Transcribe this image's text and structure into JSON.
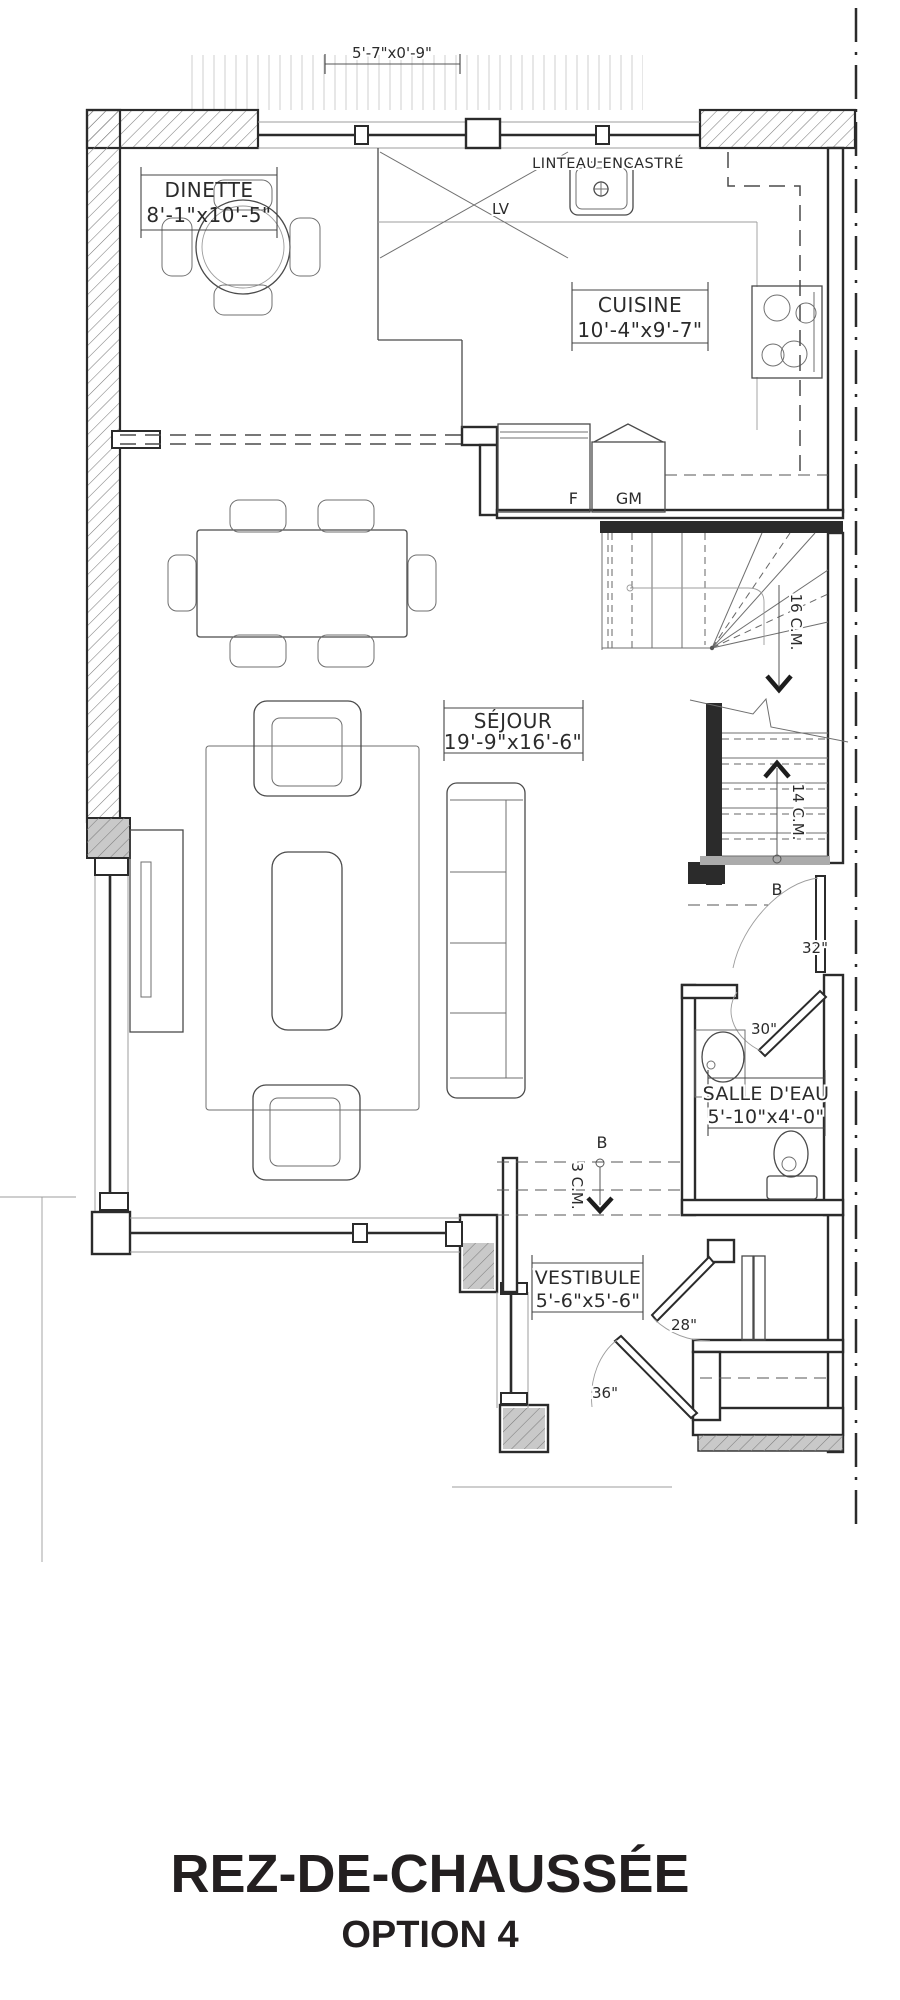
{
  "plan": {
    "porch_dim": "5'-7\"x0'-9\"",
    "lintel": "LINTEAU ENCASTRÉ",
    "rooms": {
      "dinette": {
        "name": "DINETTE",
        "dims": "8'-1\"x10'-5\""
      },
      "cuisine": {
        "name": "CUISINE",
        "dims": "10'-4\"x9'-7\""
      },
      "sejour": {
        "name": "SÉJOUR",
        "dims": "19'-9\"x16'-6\""
      },
      "salle_deau": {
        "name": "SALLE D'EAU",
        "dims": "5'-10\"x4'-0\""
      },
      "vestibule": {
        "name": "VESTIBULE",
        "dims": "5'-6\"x5'-6\""
      }
    },
    "appliances": {
      "dishwasher": "LV",
      "fridge": "F",
      "pantry": "GM"
    },
    "stairs": {
      "up_risers": "16 C.M.",
      "down_risers": "14 C.M.",
      "entry_risers": "3 C.M."
    },
    "beams": {
      "stair_beam": "B",
      "entry_beam": "B"
    },
    "doors": {
      "stair_hall": "32\"",
      "powder_room": "30\"",
      "closet": "28\"",
      "entry": "36\""
    }
  },
  "title": {
    "main": "REZ-DE-CHAUSSÉE",
    "sub": "OPTION 4"
  },
  "colors": {
    "line": "#2b2b2b",
    "light": "#9c9c9c",
    "hatch": "#7d7d7d",
    "title": "#231f20"
  }
}
